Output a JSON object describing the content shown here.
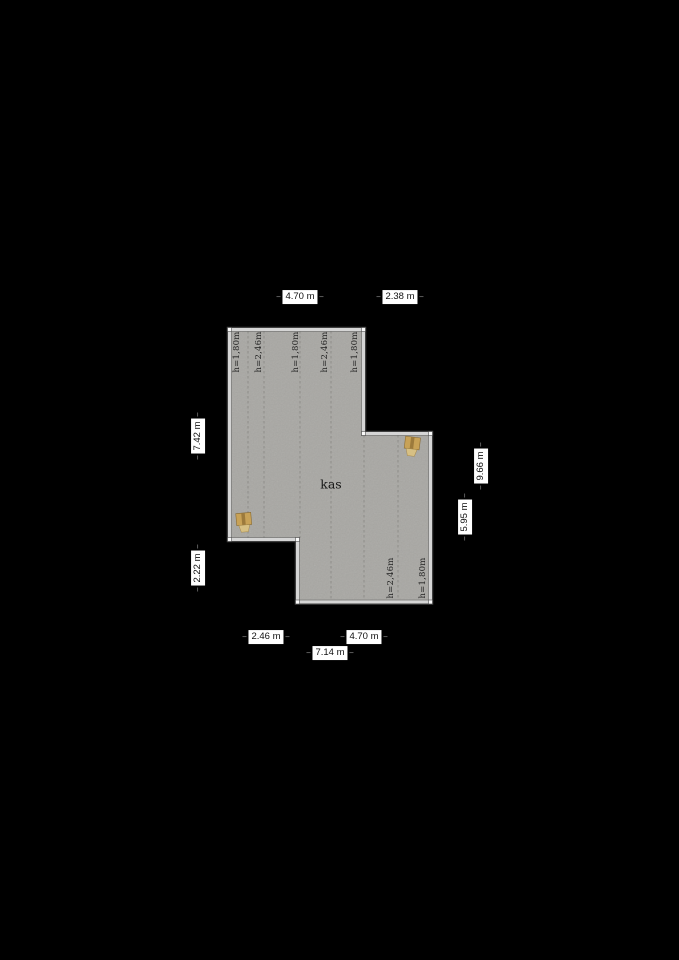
{
  "room": {
    "name": "kas"
  },
  "dim_labels": {
    "top_width_main": "4.70 m",
    "top_width_right": "2.38 m",
    "left_height_upper": "7.42 m",
    "left_height_lower": "2.22 m",
    "right_height_total": "9.66 m",
    "right_height_lower": "5.95 m",
    "bottom_width_left": "2.46 m",
    "bottom_width_right": "4.70 m",
    "bottom_width_total": "7.14 m"
  },
  "height_labels": {
    "upper": [
      "h=1,80m",
      "h=2,46m",
      "h=1,80m",
      "h=2,46m",
      "h=1,80m"
    ],
    "lower": [
      "h=2,46m",
      "h=1,80m"
    ]
  },
  "colors": {
    "bg": "#000000",
    "floor": "#a8a7a3",
    "wall": "#d5d5d5",
    "contour": "#8e8d89",
    "label_bg": "#ffffff",
    "label_text": "#111111",
    "height_text": "#222222",
    "door_wood": "#c8a257"
  }
}
